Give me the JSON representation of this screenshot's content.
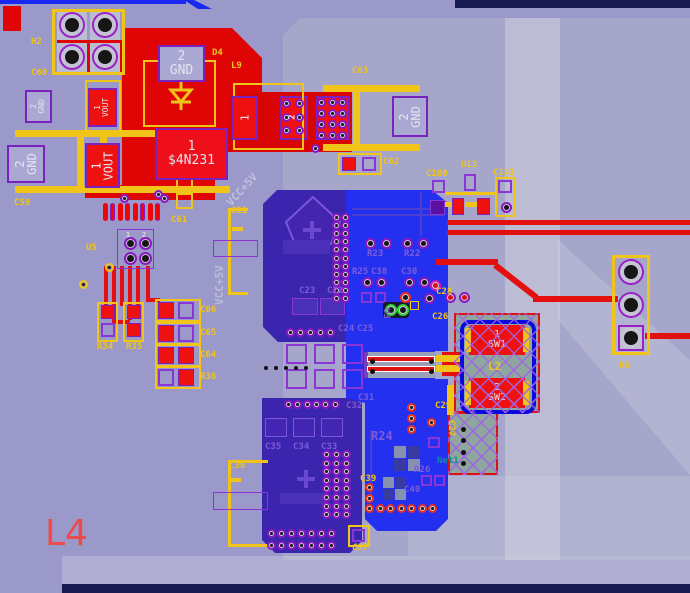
{
  "view": {
    "name": "pcb-layout-viewport",
    "zoom_region_label": "L4"
  },
  "colors": {
    "background": "#9a99c9",
    "top_layer_red": "#e00505",
    "bottom_layer_bright_blue": "#2430ef",
    "bottom_layer_indigo": "#3b24ae",
    "overlay_yellow": "#f0c419",
    "silkscreen_purple": "#7e5cd8",
    "net_teal": "#0a9090",
    "big_label_red": "#ee4a4a",
    "board_edge_navy": "#181a52"
  },
  "designators": {
    "h2": "H2",
    "c60": "C60",
    "c59": "C59",
    "d4": "D4",
    "l9": "L9",
    "c63": "C63",
    "c62": "C62",
    "c61": "C61",
    "u5": "U5",
    "r34": "R34",
    "r35": "R35",
    "r36": "R36",
    "c64": "C64",
    "c65": "C65",
    "c66": "C66",
    "c21": "C21",
    "c100": "C100",
    "u13": "U13",
    "c141": "C141",
    "h6": "H6",
    "l2": "L2",
    "c22": "C22",
    "c23": "C23",
    "c24": "C24",
    "c25": "C25",
    "c26": "C26",
    "c27": "C27",
    "c28": "C28",
    "c29": "C29",
    "c30": "C30",
    "c31": "C31",
    "c32": "C32",
    "c33": "C33",
    "c34": "C34",
    "c35": "C35",
    "c36": "C36",
    "c37": "C37",
    "c38": "C38",
    "c39": "C39",
    "c40": "C40",
    "r22": "R22",
    "r23": "R23",
    "r24": "R24",
    "r25": "R25",
    "r26": "R26",
    "u3": "U3",
    "l4": "L4"
  },
  "pads": {
    "d4_pin2": {
      "num": "2",
      "name": "GND"
    },
    "d4_pin1": {
      "num": "1",
      "name": "$4N231"
    },
    "c59_pin2": {
      "num": "2",
      "name": "GND"
    },
    "c59_pin1": {
      "num": "1",
      "name": "VOUT"
    },
    "c60_pin2": {
      "num": "2",
      "name": "GND"
    },
    "c60_pin1": {
      "num": "1",
      "name": "VOUT"
    },
    "c63_gnd": {
      "num": "2",
      "name": "GND"
    },
    "l9_pin1": "1",
    "l9_pin2": "2",
    "l2_pin1": {
      "num": "1",
      "name": "SW1"
    },
    "l2_pin2": {
      "num": "2",
      "name": "SW2"
    },
    "u5_pin1": "1",
    "u5_pin2": "2"
  },
  "nets": {
    "net1": "Net1",
    "vcc": "VCC+5V"
  }
}
